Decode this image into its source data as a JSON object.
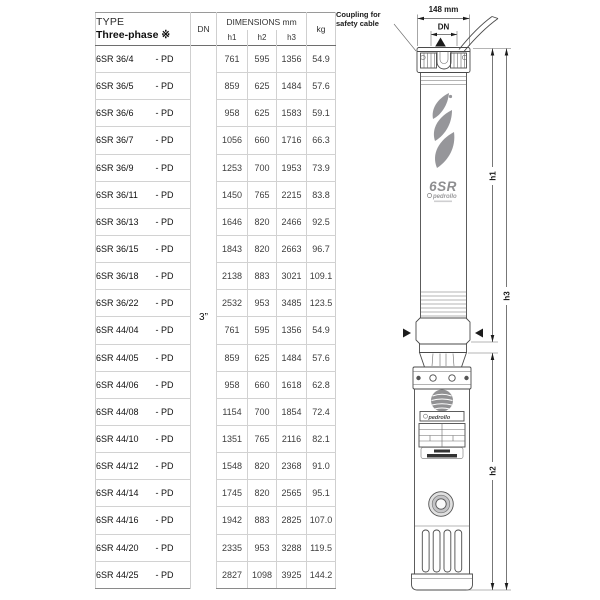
{
  "table": {
    "header": {
      "type_label": "TYPE",
      "type_sub": "Three-phase ※",
      "dn": "DN",
      "dimensions": "DIMENSIONS mm",
      "h1": "h1",
      "h2": "h2",
      "h3": "h3",
      "kg": "kg"
    },
    "dn_value": "3”",
    "rows": [
      {
        "name": "6SR 36/4",
        "suffix": "- PD",
        "h1": "761",
        "h2": "595",
        "h3": "1356",
        "kg": "54.9"
      },
      {
        "name": "6SR 36/5",
        "suffix": "- PD",
        "h1": "859",
        "h2": "625",
        "h3": "1484",
        "kg": "57.6"
      },
      {
        "name": "6SR 36/6",
        "suffix": "- PD",
        "h1": "958",
        "h2": "625",
        "h3": "1583",
        "kg": "59.1"
      },
      {
        "name": "6SR 36/7",
        "suffix": "- PD",
        "h1": "1056",
        "h2": "660",
        "h3": "1716",
        "kg": "66.3"
      },
      {
        "name": "6SR 36/9",
        "suffix": "- PD",
        "h1": "1253",
        "h2": "700",
        "h3": "1953",
        "kg": "73.9"
      },
      {
        "name": "6SR 36/11",
        "suffix": "- PD",
        "h1": "1450",
        "h2": "765",
        "h3": "2215",
        "kg": "83.8"
      },
      {
        "name": "6SR 36/13",
        "suffix": "- PD",
        "h1": "1646",
        "h2": "820",
        "h3": "2466",
        "kg": "92.5"
      },
      {
        "name": "6SR 36/15",
        "suffix": "- PD",
        "h1": "1843",
        "h2": "820",
        "h3": "2663",
        "kg": "96.7"
      },
      {
        "name": "6SR 36/18",
        "suffix": "- PD",
        "h1": "2138",
        "h2": "883",
        "h3": "3021",
        "kg": "109.1"
      },
      {
        "name": "6SR 36/22",
        "suffix": "- PD",
        "h1": "2532",
        "h2": "953",
        "h3": "3485",
        "kg": "123.5"
      },
      {
        "name": "6SR 44/04",
        "suffix": "- PD",
        "h1": "761",
        "h2": "595",
        "h3": "1356",
        "kg": "54.9"
      },
      {
        "name": "6SR 44/05",
        "suffix": "- PD",
        "h1": "859",
        "h2": "625",
        "h3": "1484",
        "kg": "57.6"
      },
      {
        "name": "6SR 44/06",
        "suffix": "- PD",
        "h1": "958",
        "h2": "660",
        "h3": "1618",
        "kg": "62.8"
      },
      {
        "name": "6SR 44/08",
        "suffix": "- PD",
        "h1": "1154",
        "h2": "700",
        "h3": "1854",
        "kg": "72.4"
      },
      {
        "name": "6SR 44/10",
        "suffix": "- PD",
        "h1": "1351",
        "h2": "765",
        "h3": "2116",
        "kg": "82.1"
      },
      {
        "name": "6SR 44/12",
        "suffix": "- PD",
        "h1": "1548",
        "h2": "820",
        "h3": "2368",
        "kg": "91.0"
      },
      {
        "name": "6SR 44/14",
        "suffix": "- PD",
        "h1": "1745",
        "h2": "820",
        "h3": "2565",
        "kg": "95.1"
      },
      {
        "name": "6SR 44/16",
        "suffix": "- PD",
        "h1": "1942",
        "h2": "883",
        "h3": "2825",
        "kg": "107.0"
      },
      {
        "name": "6SR 44/20",
        "suffix": "- PD",
        "h1": "2335",
        "h2": "953",
        "h3": "3288",
        "kg": "119.5"
      },
      {
        "name": "6SR 44/25",
        "suffix": "- PD",
        "h1": "2827",
        "h2": "1098",
        "h3": "3925",
        "kg": "144.2"
      }
    ]
  },
  "drawing": {
    "coupling_label_1": "Coupling for",
    "coupling_label_2": "safety cable",
    "width_dim": "148 mm",
    "dn_dim": "DN",
    "h1": "h1",
    "h2": "h2",
    "h3": "h3",
    "brand_model": "6SR",
    "brand": "pedrollo",
    "brand_small": "pedrollo"
  },
  "colors": {
    "line": "#4b4b4b",
    "logo_grey": "#96969a",
    "text": "#1a1a1a"
  }
}
